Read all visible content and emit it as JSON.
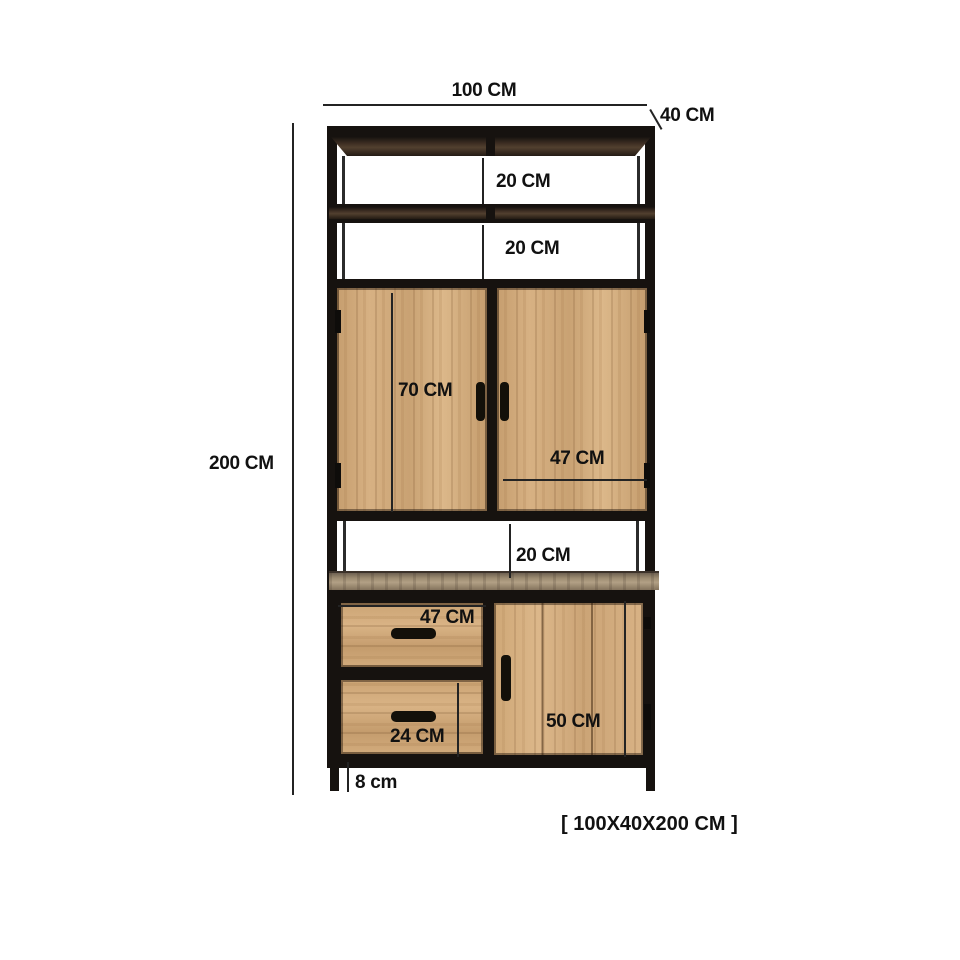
{
  "labels": {
    "total_width": "100 CM",
    "depth": "40 CM",
    "total_height": "200 CM",
    "shelf_gap_1": "20 CM",
    "shelf_gap_2": "20 CM",
    "upper_door_height": "70 CM",
    "upper_door_width": "47 CM",
    "middle_gap": "20 CM",
    "drawer_width": "47 CM",
    "drawer_height": "24 CM",
    "lower_door_height": "50 CM",
    "leg_height": "8 cm",
    "overall_size": "[ 100X40X200 CM ]"
  },
  "dimensions_cm": {
    "width": 100,
    "depth": 40,
    "height": 200,
    "open_shelf_gap_top": 20,
    "open_shelf_gap_second": 20,
    "upper_door_height": 70,
    "upper_door_width": 47,
    "middle_open_gap": 20,
    "drawer_width": 47,
    "lower_drawer_height": 24,
    "lower_door_height": 50,
    "leg_height": 8
  },
  "colors": {
    "background": "#ffffff",
    "frame_metal": "#16120f",
    "light_wood": "#cfa877",
    "dark_shelf_wood": "#3f2f23",
    "middle_shelf_wood": "#9c8b71",
    "annotation_text": "#111111",
    "dimension_line": "#232323"
  }
}
